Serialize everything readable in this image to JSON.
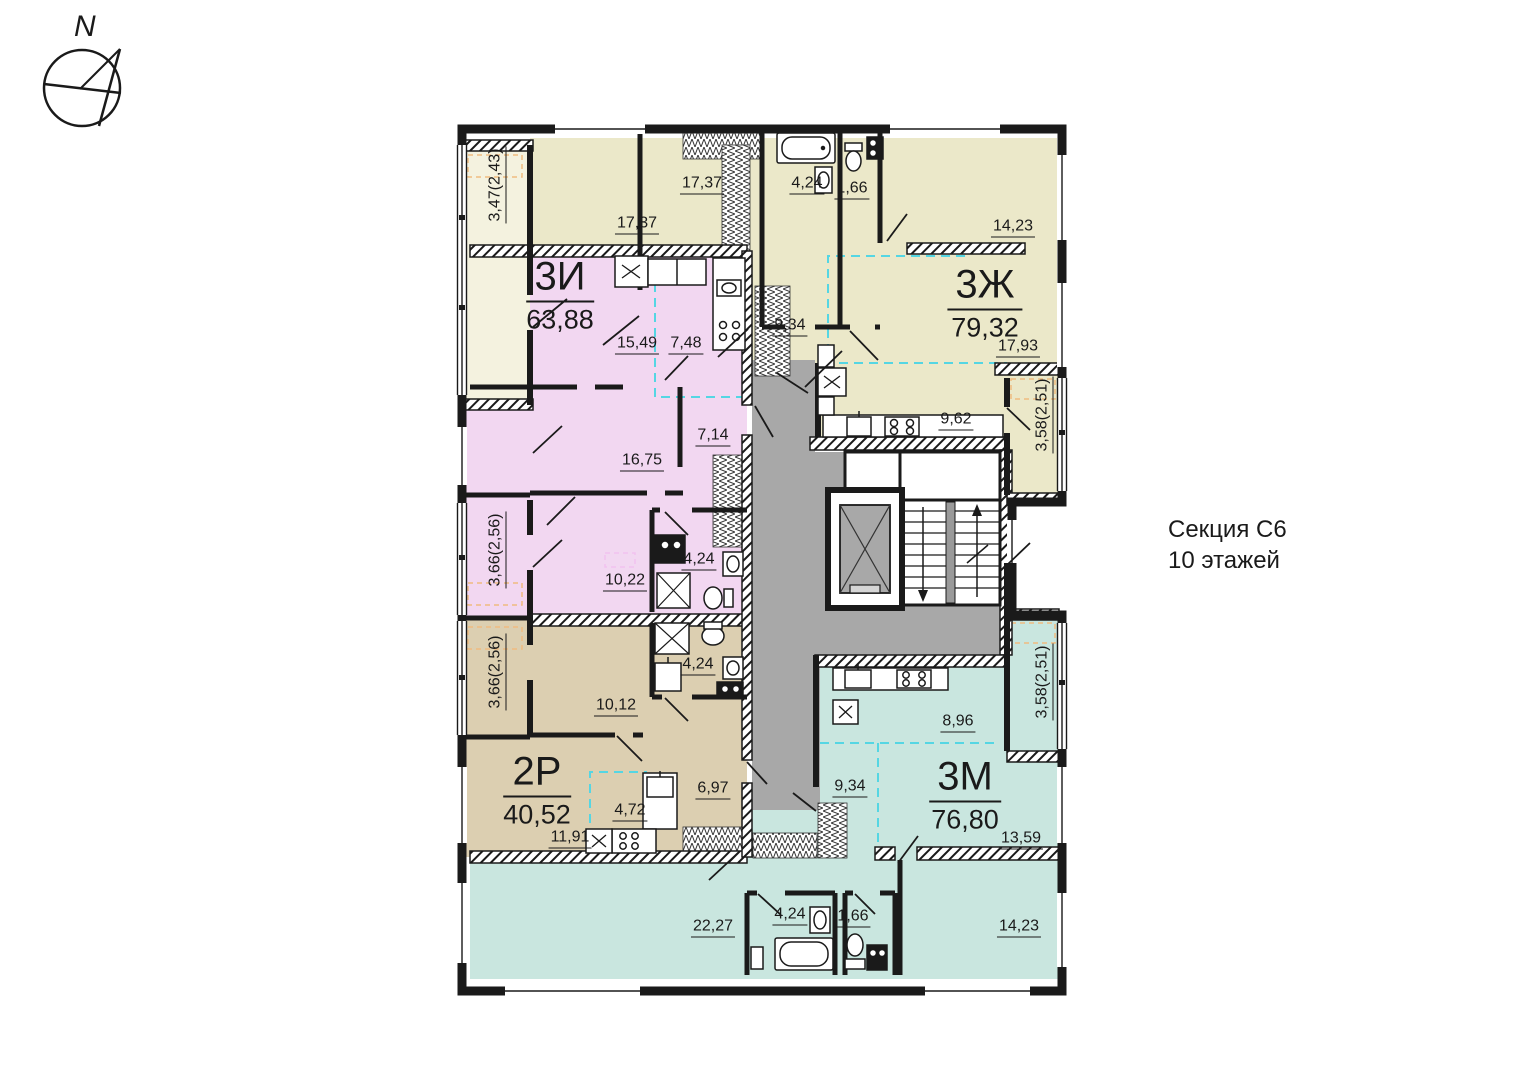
{
  "compass": {
    "north_label": "N"
  },
  "section_info": {
    "name": "Секция С6",
    "floors": "10 этажей"
  },
  "colors": {
    "wall": "#1a1a1a",
    "core_gray": "#a8a8a8",
    "cyan_dash": "#55d6e3",
    "orange_dash": "#f0bc80"
  },
  "apartments": [
    {
      "id": "3i",
      "name": "3И",
      "area": "63,88",
      "color": "#f2d7f1",
      "rooms": {
        "living": "15,49",
        "kitchen": "7,48",
        "hall": "7,14",
        "bedroom1": "16,75",
        "bedroom2": "10,22",
        "bath": "4,24",
        "loggia": "3,66(2,56)"
      }
    },
    {
      "id": "3zh",
      "name": "3Ж",
      "area": "79,32",
      "color": "#ebe8c9",
      "rooms": {
        "bedroom1": "17,37",
        "wardrobe": "17,37",
        "bath": "4,24",
        "wc": "1,66",
        "bedroom2": "14,23",
        "hall": "9,34",
        "living": "17,93",
        "kitchen": "9,62",
        "loggia1": "3,47(2,43)",
        "loggia2": "3,58(2,51)"
      }
    },
    {
      "id": "2r",
      "name": "2Р",
      "area": "40,52",
      "color": "#dccfb1",
      "rooms": {
        "bedroom": "10,12",
        "bath": "4,24",
        "hall": "6,97",
        "kitchen": "4,72",
        "living": "11,91",
        "loggia": "3,66(2,56)"
      }
    },
    {
      "id": "3m",
      "name": "3М",
      "area": "76,80",
      "color": "#c9e6df",
      "rooms": {
        "kitchen": "8,96",
        "hall": "9,34",
        "living": "13,59",
        "bedroom1": "22,27",
        "bath": "4,24",
        "wc": "1,66",
        "bedroom2": "14,23",
        "loggia": "3,58(2,51)"
      }
    }
  ]
}
